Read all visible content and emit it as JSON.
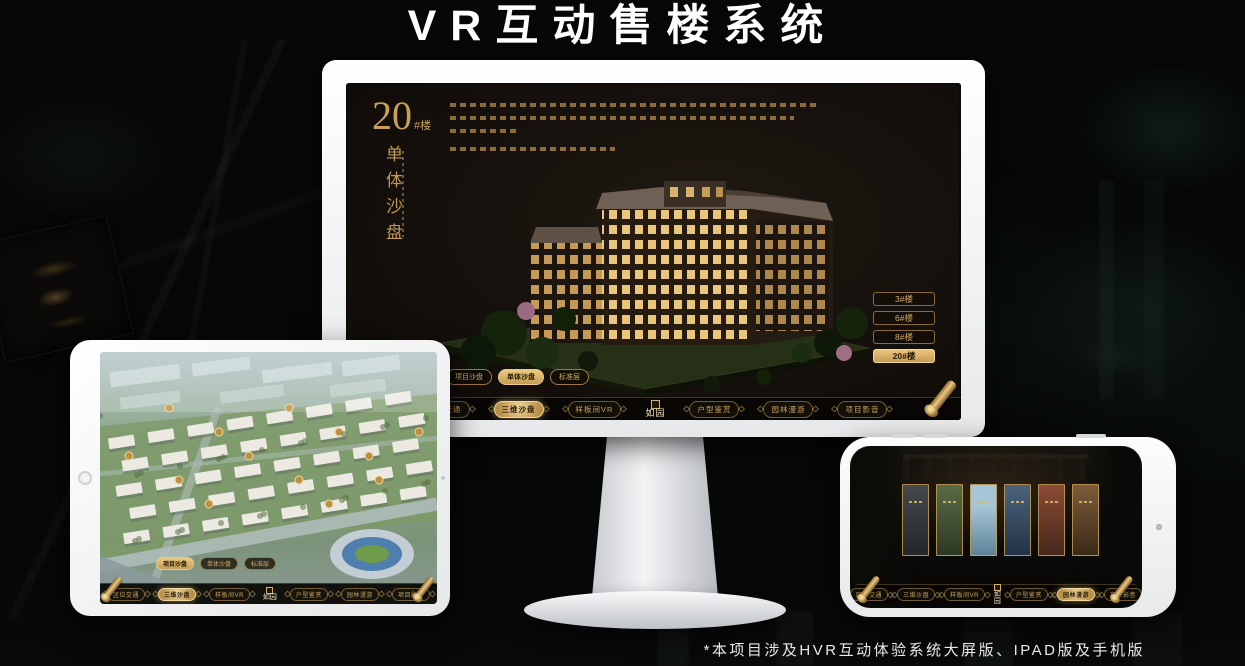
{
  "page": {
    "title": "VR互动售楼系统",
    "footnote": "*本项目涉及HVR互动体验系统大屏版、IPAD版及手机版"
  },
  "colors": {
    "gold": "#c9a45f",
    "gold_active": "#e2bd73",
    "screen_bg": "#16110d",
    "background": "#060807"
  },
  "nav": {
    "items": [
      "区位交通",
      "三维沙盘",
      "样板间VR",
      "户型鉴赏",
      "园林漫游",
      "项目影音"
    ],
    "logo": "如园"
  },
  "monitor": {
    "unit_number": "20",
    "unit_suffix": "#楼",
    "unit_title": "单体沙盘",
    "floor_buttons": [
      {
        "label": "3#楼",
        "active": false
      },
      {
        "label": "6#楼",
        "active": false
      },
      {
        "label": "8#楼",
        "active": false
      },
      {
        "label": "20#楼",
        "active": true
      }
    ],
    "view_tabs": [
      {
        "label": "项目沙盘",
        "active": false
      },
      {
        "label": "单体沙盘",
        "active": true
      },
      {
        "label": "标准层",
        "active": false
      }
    ],
    "active_nav_item": "三维沙盘"
  },
  "tablet": {
    "view_tabs": [
      {
        "label": "项目沙盘",
        "active": true
      },
      {
        "label": "单体沙盘",
        "active": false
      },
      {
        "label": "标准层",
        "active": false
      }
    ],
    "active_nav_item": "三维沙盘"
  },
  "phone": {
    "active_nav_item": "园林漫游"
  }
}
